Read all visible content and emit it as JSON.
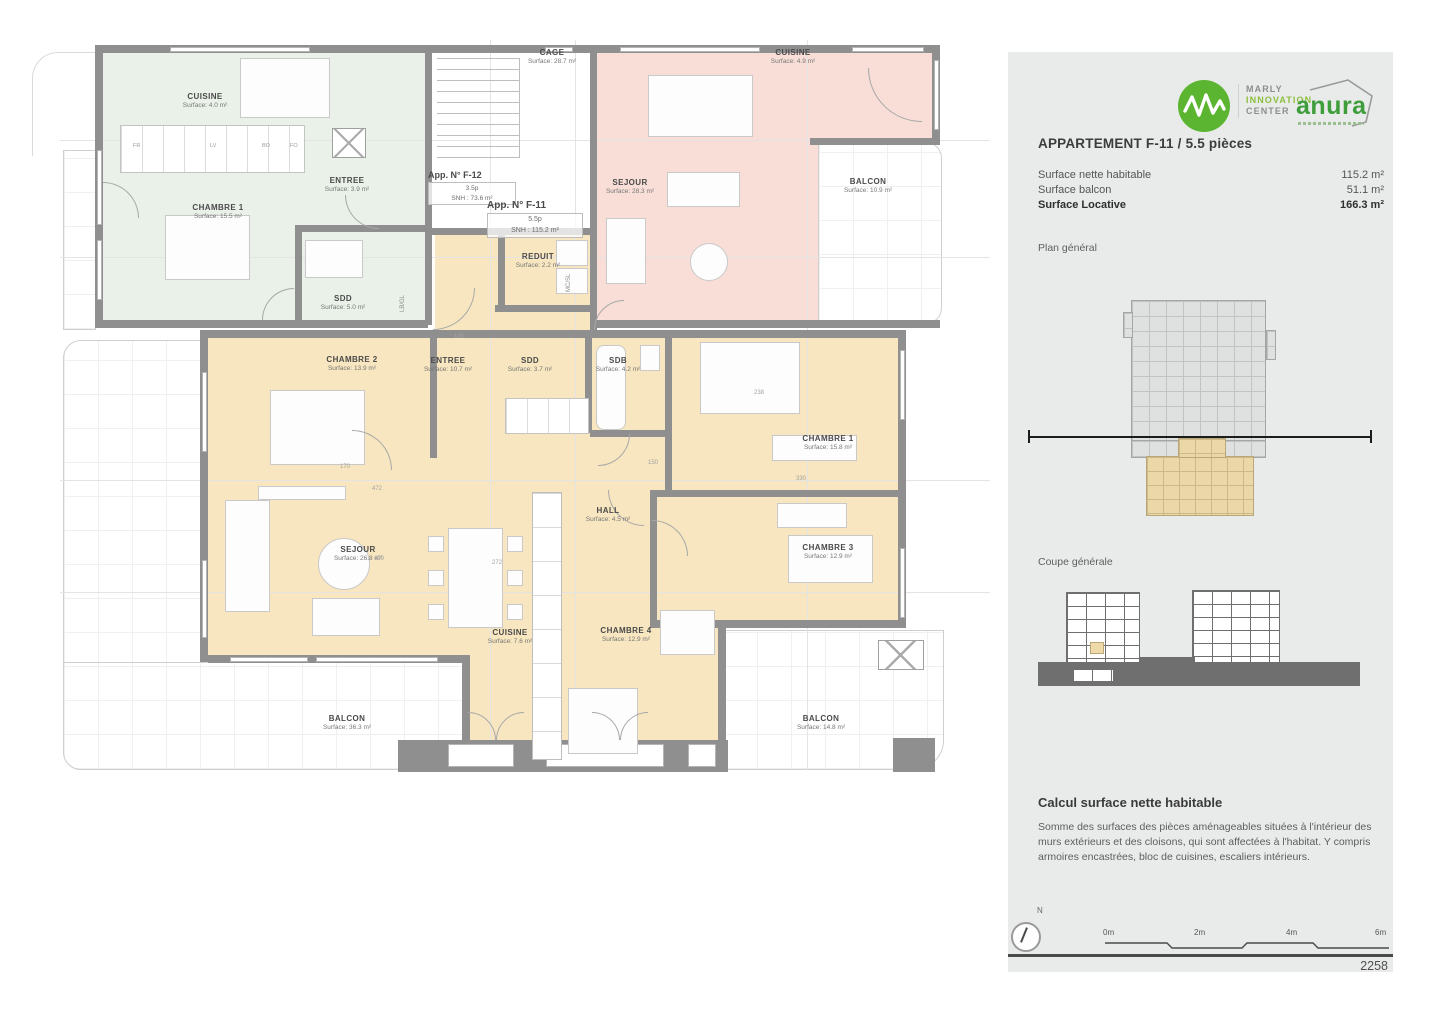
{
  "plan": {
    "rooms": [
      {
        "name": "CUISINE",
        "surface": "Surface: 4.0 m²"
      },
      {
        "name": "CHAMBRE 1",
        "surface": "Surface: 15.5 m²"
      },
      {
        "name": "ENTREE",
        "surface": "Surface: 3.9 m²"
      },
      {
        "name": "SDD",
        "surface": "Surface: 5.0 m²"
      },
      {
        "name": "CAGE",
        "surface": "Surface: 28.7 m²"
      },
      {
        "name": "SEJOUR",
        "surface": "Surface: 28.3 m²"
      },
      {
        "name": "CUISINE",
        "surface": "Surface: 4.9 m²"
      },
      {
        "name": "BALCON",
        "surface": "Surface: 10.9 m²"
      },
      {
        "name": "REDUIT",
        "surface": "Surface: 2.2 m²"
      },
      {
        "name": "CHAMBRE 2",
        "surface": "Surface: 13.9 m²"
      },
      {
        "name": "ENTREE",
        "surface": "Surface: 10.7 m²"
      },
      {
        "name": "SDD",
        "surface": "Surface: 3.7 m²"
      },
      {
        "name": "SDB",
        "surface": "Surface: 4.2 m²"
      },
      {
        "name": "CHAMBRE 1",
        "surface": "Surface: 15.8 m²"
      },
      {
        "name": "HALL",
        "surface": "Surface: 4.5 m²"
      },
      {
        "name": "SEJOUR",
        "surface": "Surface: 26.8 m²"
      },
      {
        "name": "CHAMBRE 3",
        "surface": "Surface: 12.9 m²"
      },
      {
        "name": "CUISINE",
        "surface": "Surface: 7.6 m²"
      },
      {
        "name": "CHAMBRE 4",
        "surface": "Surface: 12.9 m²"
      },
      {
        "name": "BALCON",
        "surface": "Surface: 36.3 m²"
      },
      {
        "name": "BALCON",
        "surface": "Surface: 14.8 m²"
      }
    ],
    "app_labels": {
      "f12": {
        "title": "App. N° F-12",
        "pieces": "3.5p",
        "snh": "SNH : 73.6 m²"
      },
      "f11": {
        "title": "App. N° F-11",
        "pieces": "5.5p",
        "snh": "SNH : 115.2 m²"
      }
    },
    "tech_labels": {
      "reduit": "MC/SL",
      "green": "LB/GL"
    },
    "micro_labels": [
      "FR",
      "LV",
      "BO",
      "FO"
    ],
    "dims": [
      "472",
      "479",
      "272",
      "170",
      "150",
      "330",
      "238",
      "130"
    ]
  },
  "panel": {
    "marly": {
      "line1": "MARLY",
      "line2": "INNOVATION",
      "line3": "CENTER"
    },
    "anura": "anura",
    "title": "APPARTEMENT F-11 / 5.5 pièces",
    "surface_rows": [
      {
        "label": "Surface nette habitable",
        "value": "115.2 m²"
      },
      {
        "label": "Surface balcon",
        "value": "51.1 m²"
      },
      {
        "label": "Surface Locative",
        "value": "166.3 m²"
      }
    ],
    "plan_general": "Plan général",
    "coupe": "Coupe générale",
    "calc_title": "Calcul surface nette habitable",
    "calc_body": "Somme des surfaces des pièces aménageables situées à l'intérieur des murs extérieurs et des cloisons, qui sont affectées à l'habitat. Y compris armoires encastrées, bloc de cuisines, escaliers intérieurs.",
    "compass": "N",
    "scale_ticks": [
      "0m",
      "2m",
      "4m",
      "6m"
    ],
    "sheet_number": "2258"
  }
}
